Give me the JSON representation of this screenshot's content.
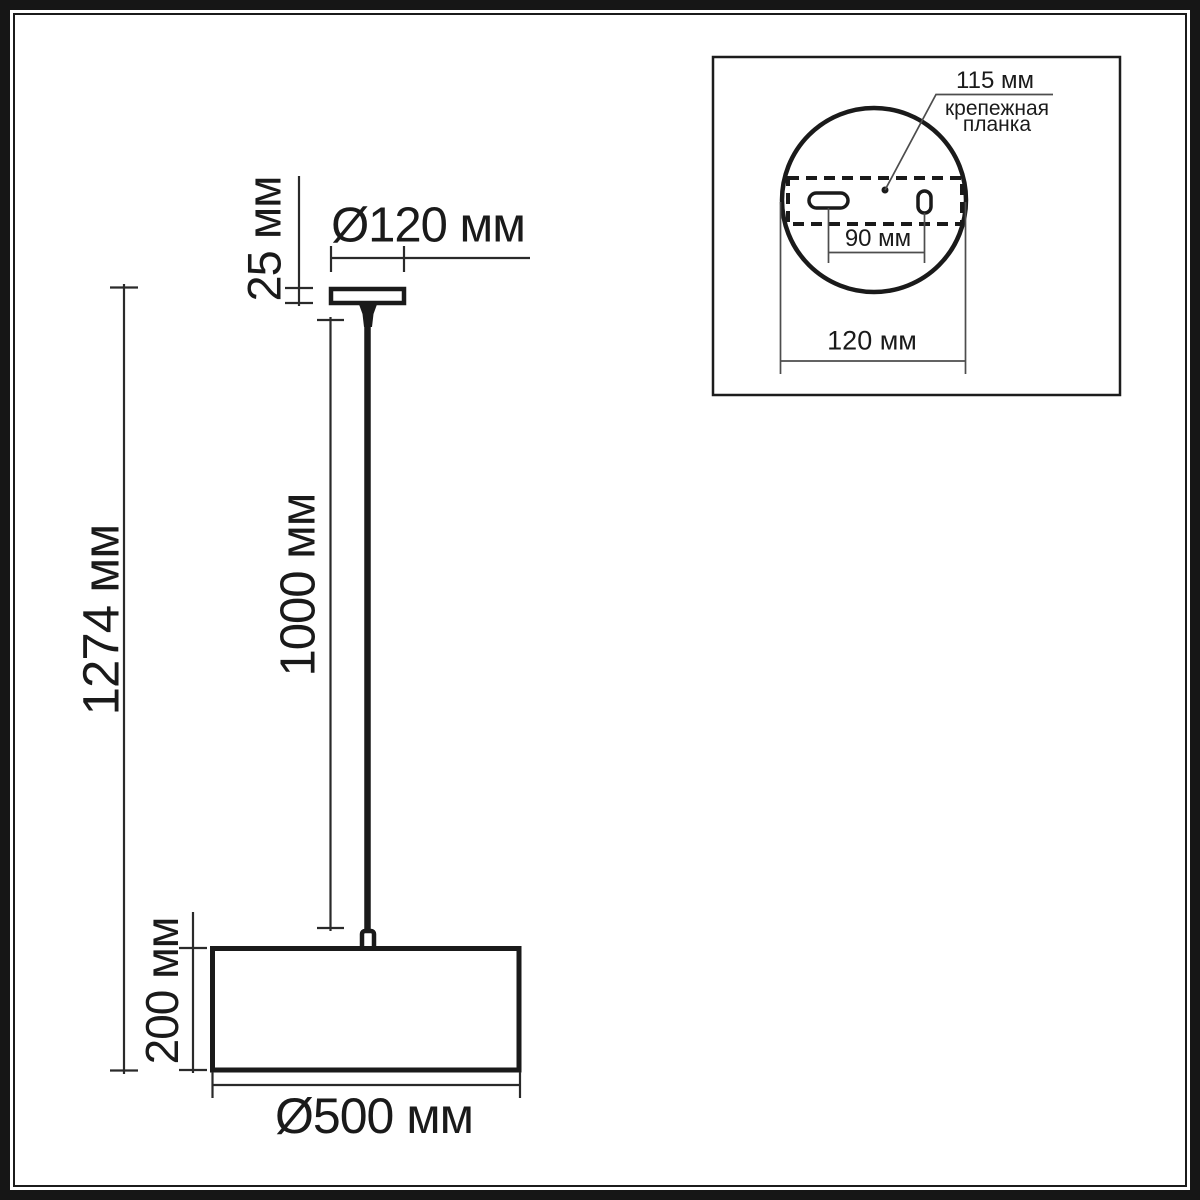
{
  "diagram": {
    "title": "pendant lamp dimensional drawing",
    "labels": {
      "total_height": "1274 мм",
      "canopy_height": "25 мм",
      "canopy_diameter": "Ø120 мм",
      "cord_length": "1000 мм",
      "shade_height": "200 мм",
      "shade_diameter": "Ø500 мм"
    }
  },
  "inset": {
    "plate_length": "115 мм",
    "plate_label_line1": "крепежная",
    "plate_label_line2": "планка",
    "hole_spacing": "90 мм",
    "base_diameter": "120 мм"
  },
  "colors": {
    "ink": "#1a1a1a",
    "dim_line": "#2a2a2a",
    "thin_leader": "#4d4d4d",
    "background": "#ffffff"
  }
}
